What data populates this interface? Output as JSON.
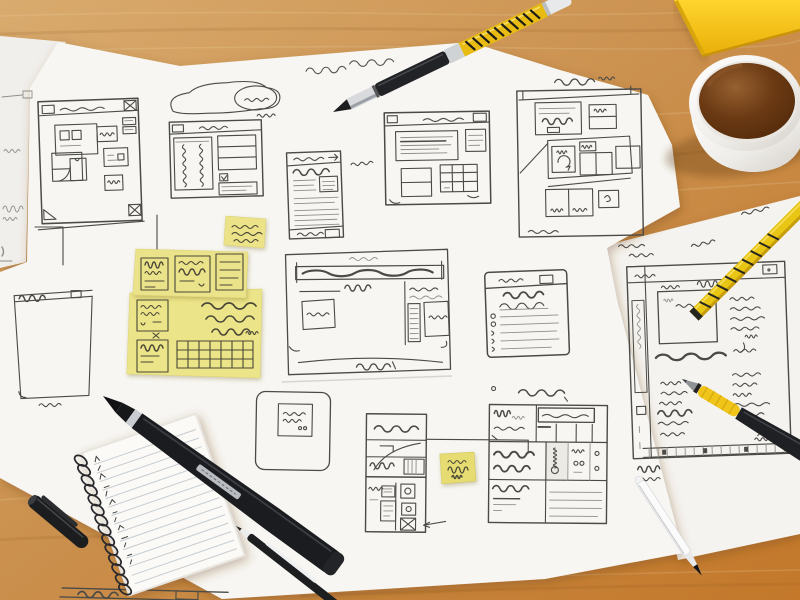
{
  "scene": {
    "description": "Photograph of hand-drawn website wireframe sketches on white paper sheets lying on a wooden desk, surrounded by pens, a yellow pencil, sticky notes, a spiral notepad, a yellow notebook corner and a cup of coffee",
    "surface": "wooden desk",
    "colors": {
      "desk_wood": "#cd9a5e",
      "desk_warm": "#c47a28",
      "paper": "#f7f6f2",
      "sticky_note": "#ebe38a",
      "sticky_note_bright": "#e7dc72",
      "ink": "#4a4a47",
      "pencil_marks": "#8e8e88",
      "pen_yellow": "#e8bb12",
      "pencil_yellow": "#e9c514",
      "coffee": "#63340f",
      "cup": "#f2f1ed",
      "notebook_cover": "#f6c91c"
    },
    "objects": {
      "paper_sheet_left": "left paper sheet edge with faint pencil marks",
      "paper_sheet_main": "main paper sheet covered in wireframe sketches",
      "paper_sheet_right": "right paper sheet with profile page wireframe",
      "wireframe_dashboard": "browser window sketch with corner crop marks and grid of content blocks",
      "wireframe_cloud_landing": "landing page sketch with cloud shape and speech bubble above header",
      "wireframe_mobile_list": "narrow mobile screen sketch with header, list rows and footer",
      "wireframe_content_window": "browser window sketch with large text block and side panels",
      "wireframe_storyboard": "storyboard sketch with three rows of boxes and refresh icon",
      "wireframe_blank_panel": "tall empty panel sketch with scribbled header bar",
      "wireframe_hero_banner": "wide banner sketch with bold heading bar, side list column and footer curve",
      "wireframe_modal_card": "rounded modal card sketch with inner label box",
      "wireframe_detail_card": "sectioned card sketch with cells, sweeping curve and pointer arrow",
      "wireframe_form_list": "form sketch with heading, underline and bulleted lines",
      "wireframe_pricing_table": "table sketch with handwritten cells and line rows",
      "wireframe_profile_page": "page sketch with sidebar, square image, text columns and tick timeline",
      "wireframe_footer_bar": "partially visible double-line bar sketch at bottom edge",
      "sticky_note_small": "small pale-yellow sticky note with three scribbled lines",
      "sticky_note_cluster": "large yellow sticky notes with boxes, handwriting and a grid table",
      "sticky_note_flag": "small bright-yellow sticky note joined by a connector line",
      "handwritten_note_top": "cursive handwritten annotation near the top edge",
      "pen_black_yellow": "pen with black front half and yellow patterned barrel",
      "pencil_yellow": "yellow pencil with black markings",
      "pen_yellow_grip": "black pen with yellow rubber grip",
      "pen_white": "slim white pen with dark tip",
      "marker_black": "large black marker with silver band",
      "pen_thin_black": "thin black pen with white clip",
      "pen_cap_black": "black pen cap",
      "spiral_notepad": "spiral-bound lined notepad with handwritten marks",
      "coffee_cup": "white cup filled with black coffee",
      "notebook_corner": "bright yellow notebook corner at top right"
    },
    "text_content_note": "All handwriting in the photograph is illegible scribble; no legible text is present."
  }
}
